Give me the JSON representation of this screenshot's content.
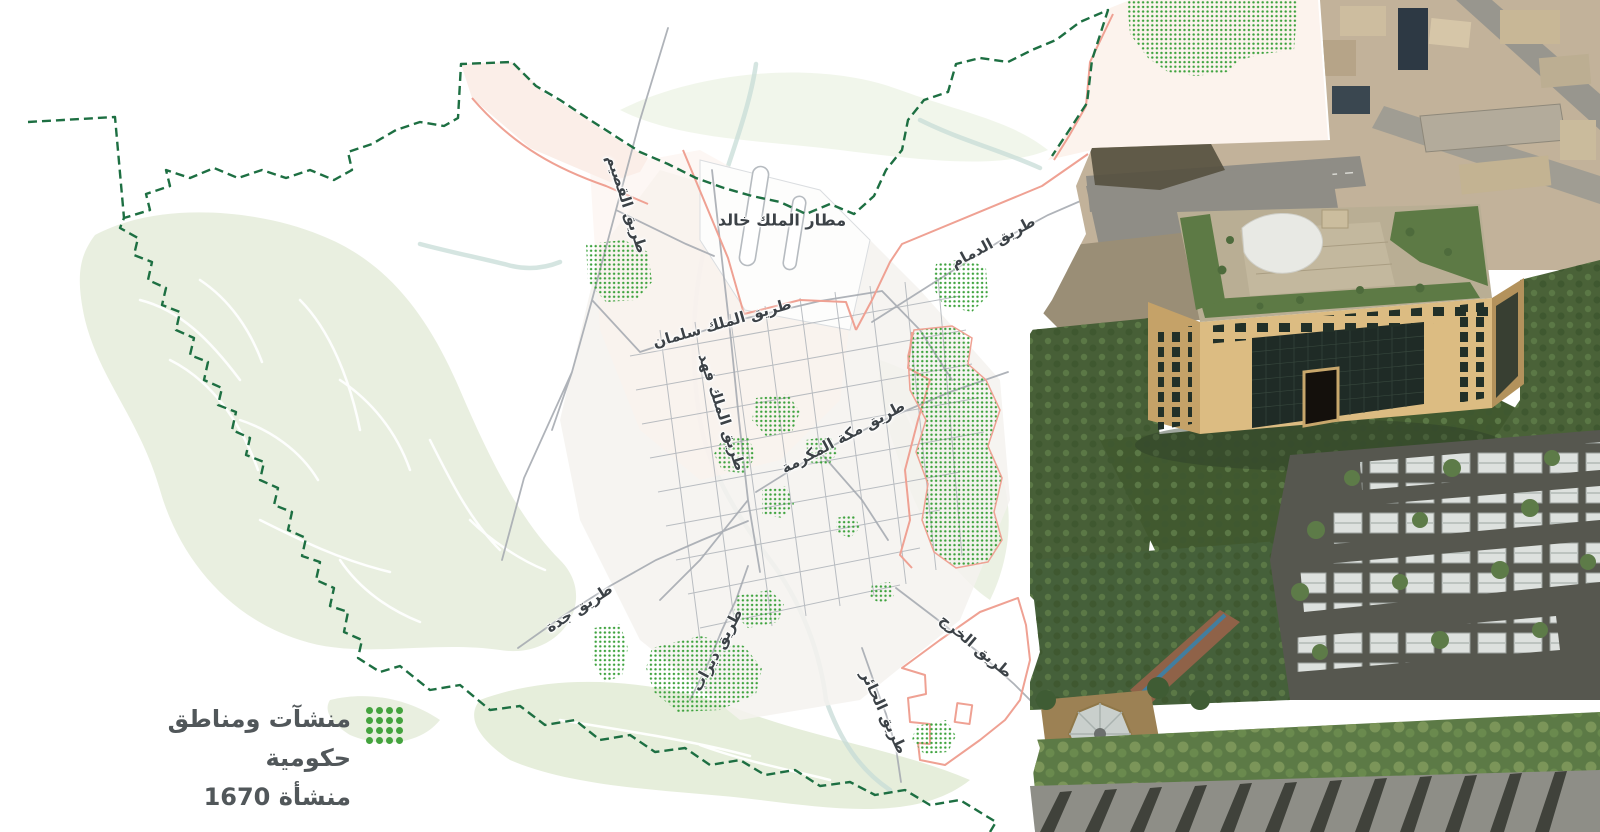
{
  "map": {
    "title_hidden": "",
    "legend": {
      "icon": "facility-dot-grid-icon",
      "line1": "منشآت ومناطق حكومية",
      "line2": "1670 منشأة"
    },
    "place_labels": [
      {
        "id": "airport",
        "text": "مطار الملك خالد"
      }
    ],
    "road_labels": [
      {
        "id": "qassim-road",
        "text": "طريق القصيم"
      },
      {
        "id": "dammam-road",
        "text": "طريق الدمام"
      },
      {
        "id": "king-salman-road",
        "text": "طريق الملك سلمان"
      },
      {
        "id": "king-fahd-road",
        "text": "طريق الملك فهد"
      },
      {
        "id": "makkah-road",
        "text": "طريق مكة المكرمة"
      },
      {
        "id": "jeddah-road",
        "text": "طريق جدة"
      },
      {
        "id": "dirab-road",
        "text": "طريق ديراب"
      },
      {
        "id": "kharj-road",
        "text": "طريق الخرج"
      },
      {
        "id": "hair-road",
        "text": "طريق الحائر"
      }
    ],
    "colors": {
      "facility_dots": "#3da23d",
      "city_boundary": "#1d6f42",
      "ring_road": "#efa193",
      "terrain_green": "#e9efe0",
      "road_gray": "#a6abb1",
      "legend_text": "#51575a"
    }
  }
}
